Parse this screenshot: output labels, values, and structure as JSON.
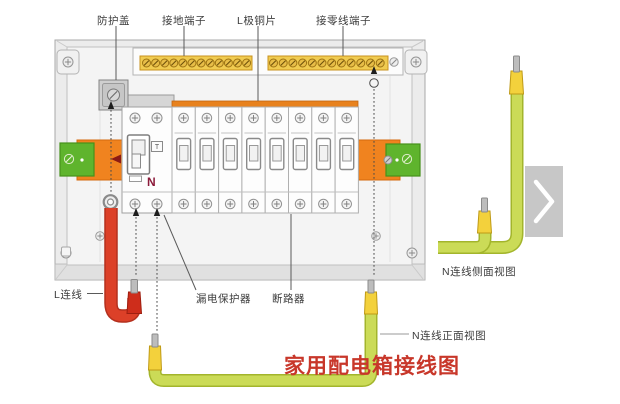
{
  "title": {
    "text": "家用配电箱接线图"
  },
  "callouts": {
    "protective_cover": "防护盖",
    "ground_terminal": "接地端子",
    "l_pole_copper": "L极铜片",
    "neutral_terminal": "接零线端子",
    "l_wire": "L连线",
    "leakage_protector": "漏电保护器",
    "circuit_breaker": "断路器",
    "n_wire_side_view": "N连线侧面视图",
    "n_wire_front_view": "N连线正面视图"
  },
  "device_marks": {
    "neutral": "N",
    "test_button": "T"
  },
  "layout_counts": {
    "breakers": 8,
    "left_terminal_screws": 12,
    "right_terminal_screws": 12,
    "busbar_teeth": 9
  },
  "colors": {
    "title_red": "#c8372a",
    "busbar_orange": "#e8821e",
    "rail_block_orange": "#f0831f",
    "terminal_green": "#5fb42d",
    "l_wire_red": "#dc4028",
    "l_wire_red_dark": "#b4301e",
    "n_wire_green": "#cbdb57",
    "n_wire_green_dark": "#a3b52c",
    "ferrule_yellow": "#f3d13c",
    "neutral_mark_color": "#8b1a3a"
  }
}
